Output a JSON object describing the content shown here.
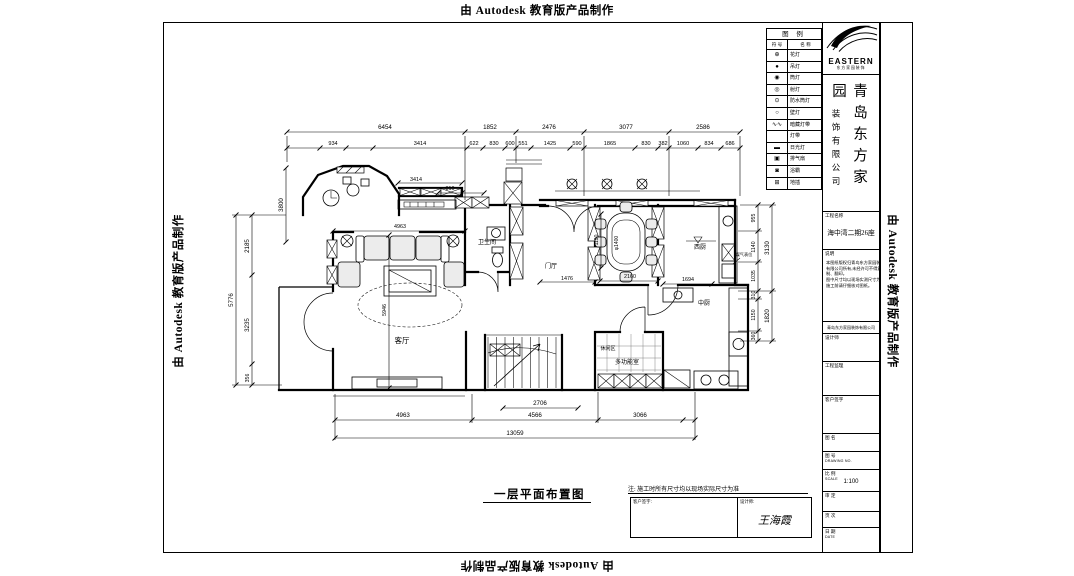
{
  "watermark": {
    "top": "由 Autodesk 教育版产品制作",
    "bottom": "由 Autodesk 教育版产品制作",
    "left": "由 Autodesk 教育版产品制作",
    "right": "由 Autodesk 教育版产品制作"
  },
  "legend": {
    "title": "图 例",
    "col_symbol": "符 号",
    "col_name": "名 称",
    "rows": [
      {
        "symbol": "⊕",
        "name": "花灯"
      },
      {
        "symbol": "●",
        "name": "吊灯"
      },
      {
        "symbol": "◉",
        "name": "筒灯"
      },
      {
        "symbol": "◎",
        "name": "射灯"
      },
      {
        "symbol": "⊙",
        "name": "防水筒灯"
      },
      {
        "symbol": "○",
        "name": "壁灯"
      },
      {
        "symbol": "∿∿",
        "name": "暗藏灯带"
      },
      {
        "symbol": "",
        "name": "灯带"
      },
      {
        "symbol": "▬",
        "name": "日光灯"
      },
      {
        "symbol": "▣",
        "name": "排气扇"
      },
      {
        "symbol": "◙",
        "name": "浴霸"
      },
      {
        "symbol": "⊞",
        "name": "地插"
      }
    ]
  },
  "title_block": {
    "brand": "EASTERN",
    "brand_sub": "东方家园装饰",
    "company_main": "青岛东方家园",
    "company_sub": "装饰有限公司",
    "project_label": "工程名称",
    "project_value": "海中湾二期26座",
    "notes_label": "说明",
    "notes_lines": [
      "本图纸版权归青岛东方家园装饰",
      "有限公司所有,未经许可不得复",
      "制、翻印。",
      "图中尺寸均以现场实测尺寸为准,",
      "施工前请仔细核对图纸。"
    ],
    "address_line": "青岛东方家园装饰有限公司",
    "fields": [
      {
        "label": "设计师"
      },
      {
        "label": "工程监理"
      },
      {
        "label": "客户签字"
      },
      {
        "label": "图 名"
      },
      {
        "label": "图 号",
        "sub": "DRAWING NO."
      },
      {
        "label": "比 例",
        "sub": "SCALE",
        "value": "1:100"
      },
      {
        "label": "审 定"
      },
      {
        "label": "页 次"
      },
      {
        "label": "日 期",
        "sub": "DATE"
      }
    ]
  },
  "footer": {
    "drawing_title": "一层平面布置图",
    "note": "注: 施工时所有尺寸均以现场实际尺寸为准",
    "client_label": "客户签字:",
    "designer_label": "设计师:",
    "designer_name": "王海霞"
  },
  "plan": {
    "dimlines": [
      [
        287,
        132,
        740,
        132
      ],
      [
        287,
        148,
        740,
        148
      ],
      [
        236,
        215,
        236,
        385
      ],
      [
        252,
        215,
        252,
        385
      ],
      [
        286,
        168,
        286,
        242
      ],
      [
        758,
        205,
        758,
        341
      ],
      [
        772,
        205,
        772,
        341
      ],
      [
        335,
        420,
        695,
        420
      ],
      [
        503,
        408,
        578,
        408
      ],
      [
        335,
        438,
        695,
        438
      ],
      [
        398,
        183,
        462,
        183
      ],
      [
        438,
        193,
        484,
        193
      ],
      [
        333,
        231,
        465,
        231
      ],
      [
        389,
        235,
        389,
        388
      ],
      [
        540,
        282,
        595,
        282
      ],
      [
        600,
        281,
        658,
        281
      ],
      [
        663,
        284,
        712,
        284
      ],
      [
        601,
        214,
        601,
        268
      ],
      [
        287,
        136,
        287,
        162
      ],
      [
        465,
        136,
        465,
        200
      ],
      [
        516,
        136,
        516,
        163
      ],
      [
        584,
        136,
        584,
        196
      ],
      [
        669,
        136,
        669,
        196
      ],
      [
        740,
        136,
        740,
        196
      ],
      [
        335,
        394,
        335,
        440
      ],
      [
        472,
        394,
        472,
        423
      ],
      [
        598,
        392,
        598,
        423
      ],
      [
        695,
        392,
        695,
        440
      ],
      [
        232,
        215,
        286,
        215
      ],
      [
        232,
        385,
        282,
        385
      ],
      [
        740,
        205,
        776,
        205
      ],
      [
        738,
        291,
        776,
        291
      ],
      [
        740,
        341,
        776,
        341
      ],
      [
        738,
        231,
        762,
        231
      ],
      [
        738,
        262,
        762,
        262
      ],
      [
        738,
        299,
        762,
        299
      ],
      [
        738,
        331,
        762,
        331
      ]
    ],
    "ticks": [
      [
        287,
        132
      ],
      [
        465,
        132
      ],
      [
        516,
        132
      ],
      [
        584,
        132
      ],
      [
        669,
        132
      ],
      [
        740,
        132
      ],
      [
        287,
        148
      ],
      [
        320,
        148
      ],
      [
        346,
        148
      ],
      [
        373,
        148
      ],
      [
        467,
        148
      ],
      [
        483,
        148
      ],
      [
        505,
        148
      ],
      [
        516,
        148
      ],
      [
        531,
        148
      ],
      [
        570,
        148
      ],
      [
        584,
        148
      ],
      [
        635,
        148
      ],
      [
        658,
        148
      ],
      [
        669,
        148
      ],
      [
        698,
        148
      ],
      [
        721,
        148
      ],
      [
        740,
        148
      ],
      [
        236,
        215
      ],
      [
        236,
        385
      ],
      [
        252,
        215
      ],
      [
        252,
        275
      ],
      [
        252,
        364
      ],
      [
        252,
        385
      ],
      [
        286,
        168
      ],
      [
        286,
        242
      ],
      [
        758,
        205
      ],
      [
        758,
        231
      ],
      [
        758,
        262
      ],
      [
        758,
        291
      ],
      [
        758,
        299
      ],
      [
        758,
        331
      ],
      [
        758,
        341
      ],
      [
        772,
        205
      ],
      [
        772,
        291
      ],
      [
        772,
        341
      ],
      [
        335,
        420
      ],
      [
        472,
        420
      ],
      [
        598,
        420
      ],
      [
        683,
        420
      ],
      [
        695,
        420
      ],
      [
        503,
        408
      ],
      [
        578,
        408
      ],
      [
        335,
        438
      ],
      [
        695,
        438
      ],
      [
        333,
        231
      ],
      [
        465,
        231
      ],
      [
        398,
        183
      ],
      [
        462,
        183
      ],
      [
        438,
        193
      ],
      [
        462,
        193
      ],
      [
        484,
        193
      ],
      [
        389,
        235
      ],
      [
        389,
        388
      ],
      [
        540,
        282
      ],
      [
        595,
        282
      ],
      [
        600,
        281
      ],
      [
        658,
        281
      ],
      [
        663,
        284
      ],
      [
        712,
        284
      ],
      [
        601,
        214
      ],
      [
        601,
        268
      ]
    ],
    "labels": [
      {
        "t": "6454",
        "x": 385,
        "y": 129
      },
      {
        "t": "1852",
        "x": 490,
        "y": 129
      },
      {
        "t": "2476",
        "x": 549,
        "y": 129
      },
      {
        "t": "3077",
        "x": 626,
        "y": 129
      },
      {
        "t": "2586",
        "x": 703,
        "y": 129
      },
      {
        "t": "934",
        "x": 333,
        "y": 145,
        "s": 5.6
      },
      {
        "t": "3414",
        "x": 420,
        "y": 145,
        "s": 5.6
      },
      {
        "t": "622",
        "x": 474,
        "y": 145,
        "s": 5.6
      },
      {
        "t": "830",
        "x": 494,
        "y": 145,
        "s": 5.6
      },
      {
        "t": "600",
        "x": 510,
        "y": 145,
        "s": 5.6
      },
      {
        "t": "551",
        "x": 523,
        "y": 145,
        "s": 5.6
      },
      {
        "t": "1425",
        "x": 550,
        "y": 145,
        "s": 5.6
      },
      {
        "t": "590",
        "x": 577,
        "y": 145,
        "s": 5.6
      },
      {
        "t": "1865",
        "x": 610,
        "y": 145,
        "s": 5.6
      },
      {
        "t": "830",
        "x": 646,
        "y": 145,
        "s": 5.6
      },
      {
        "t": "382",
        "x": 663,
        "y": 145,
        "s": 5.6
      },
      {
        "t": "1060",
        "x": 683,
        "y": 145,
        "s": 5.6
      },
      {
        "t": "834",
        "x": 709,
        "y": 145,
        "s": 5.6
      },
      {
        "t": "686",
        "x": 730,
        "y": 145,
        "s": 5.6
      },
      {
        "t": "5776",
        "x": 233,
        "y": 300,
        "r": -90
      },
      {
        "t": "2185",
        "x": 249,
        "y": 246,
        "r": -90
      },
      {
        "t": "3235",
        "x": 249,
        "y": 325,
        "r": -90
      },
      {
        "t": "356",
        "x": 249,
        "y": 378,
        "r": -90,
        "s": 5.2
      },
      {
        "t": "3800",
        "x": 283,
        "y": 205,
        "r": -90
      },
      {
        "t": "955",
        "x": 755,
        "y": 218,
        "r": -90,
        "s": 5.2
      },
      {
        "t": "1140",
        "x": 755,
        "y": 247,
        "r": -90,
        "s": 5.2
      },
      {
        "t": "1035",
        "x": 755,
        "y": 276,
        "r": -90,
        "s": 5.2
      },
      {
        "t": "3130",
        "x": 769,
        "y": 248,
        "r": -90
      },
      {
        "t": "310",
        "x": 755,
        "y": 295,
        "r": -90,
        "s": 5.2
      },
      {
        "t": "1150",
        "x": 755,
        "y": 315,
        "r": -90,
        "s": 5.2
      },
      {
        "t": "360",
        "x": 755,
        "y": 336,
        "r": -90,
        "s": 5.2
      },
      {
        "t": "1820",
        "x": 769,
        "y": 316,
        "r": -90
      },
      {
        "t": "4963",
        "x": 403,
        "y": 417
      },
      {
        "t": "4566",
        "x": 535,
        "y": 417
      },
      {
        "t": "3066",
        "x": 640,
        "y": 417
      },
      {
        "t": "2706",
        "x": 540,
        "y": 405
      },
      {
        "t": "13059",
        "x": 515,
        "y": 435
      },
      {
        "t": "3414",
        "x": 416,
        "y": 181,
        "s": 5.4
      },
      {
        "t": "810",
        "x": 450,
        "y": 190,
        "s": 5.4
      },
      {
        "t": "4963",
        "x": 400,
        "y": 228,
        "s": 5.4
      },
      {
        "t": "5946",
        "x": 386,
        "y": 310,
        "r": -90,
        "s": 5.4
      },
      {
        "t": "1476",
        "x": 567,
        "y": 280,
        "s": 5.4
      },
      {
        "t": "2160",
        "x": 630,
        "y": 278,
        "s": 5.4
      },
      {
        "t": "1694",
        "x": 688,
        "y": 281,
        "s": 5.4
      },
      {
        "t": "1190",
        "x": 598,
        "y": 240,
        "r": -90,
        "s": 5
      },
      {
        "t": "φ1400",
        "x": 618,
        "y": 243,
        "r": -90,
        "s": 5
      },
      {
        "t": "客厅",
        "x": 402,
        "y": 343,
        "s": 7.5,
        "n": "room-label-living"
      },
      {
        "t": "卫生间",
        "x": 487,
        "y": 244,
        "s": 6,
        "n": "room-label-bath"
      },
      {
        "t": "门厅",
        "x": 551,
        "y": 268,
        "s": 6,
        "n": "room-label-foyer"
      },
      {
        "t": "西厨",
        "x": 700,
        "y": 249,
        "s": 6,
        "n": "room-label-west-kitchen"
      },
      {
        "t": "中厨",
        "x": 704,
        "y": 305,
        "s": 6,
        "n": "room-label-chinese-kitchen"
      },
      {
        "t": "休闲区",
        "x": 608,
        "y": 350,
        "s": 5,
        "n": "room-label-leisure"
      },
      {
        "t": "多功能室",
        "x": 627,
        "y": 364,
        "s": 6,
        "n": "room-label-multifunction"
      },
      {
        "t": "煤气表位",
        "x": 744,
        "y": 256,
        "s": 4.2,
        "n": "gas-meter-label"
      }
    ]
  }
}
